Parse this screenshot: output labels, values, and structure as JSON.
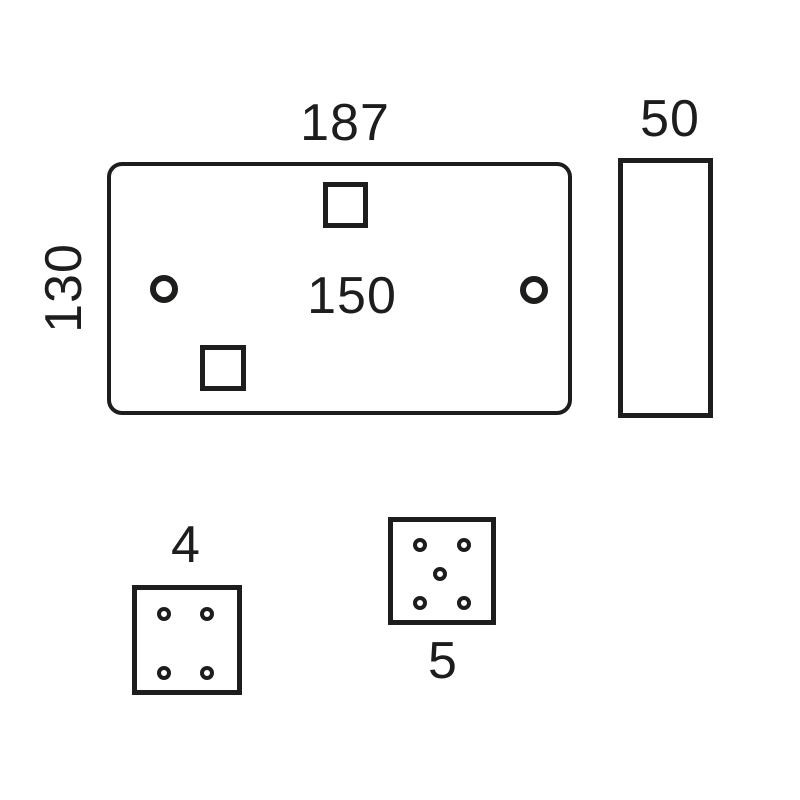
{
  "colors": {
    "ink": "#1d1d1b",
    "background": "#ffffff"
  },
  "diagram": {
    "type": "technical-dimension-drawing",
    "faceplate": {
      "width_label": "187",
      "height_label": "130",
      "fixing_centres_label": "150",
      "screw_holes": 2,
      "knockout_squares": 2
    },
    "side_profile": {
      "depth_label": "50"
    },
    "module_small": {
      "label": "4",
      "pin_holes": 4
    },
    "module_large": {
      "label": "5",
      "pin_holes": 5
    }
  }
}
